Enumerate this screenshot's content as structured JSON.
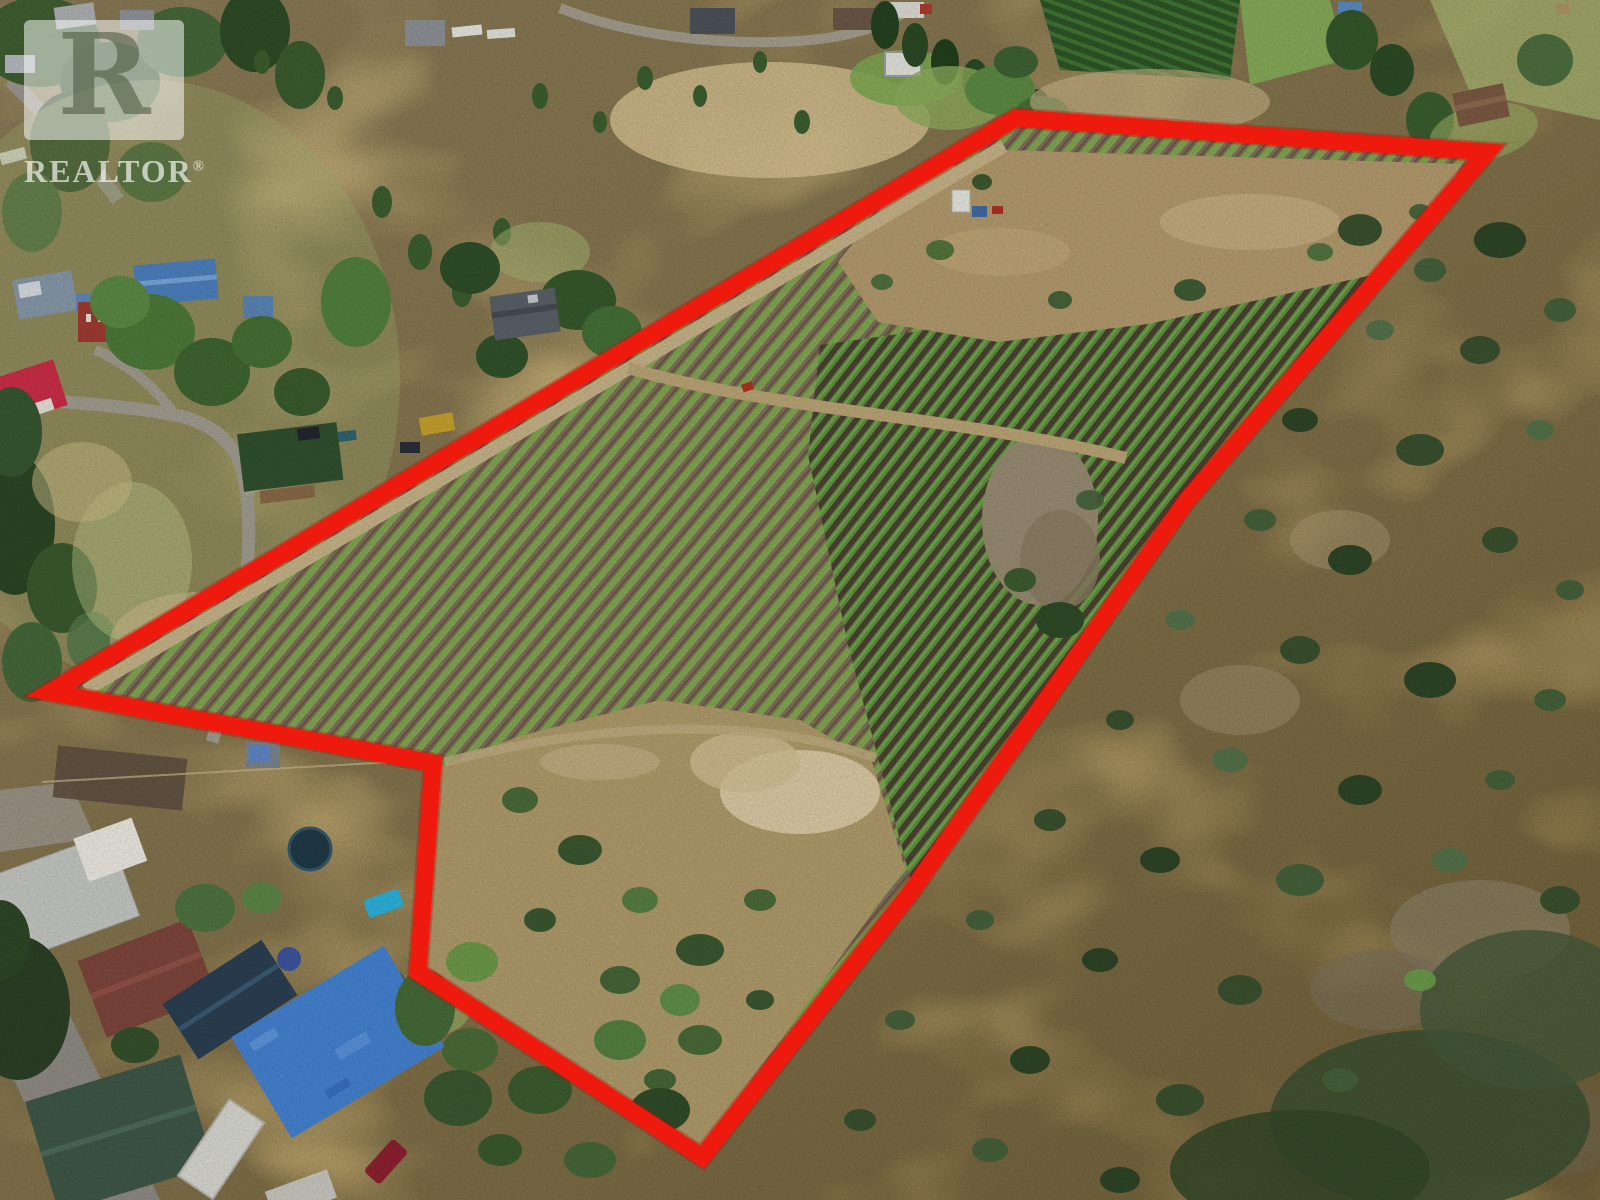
{
  "watermark": {
    "logo_letter": "R",
    "brand": "REALTOR",
    "registered_mark": "®"
  },
  "boundary": {
    "color": "#ef1a0e",
    "shadow_color": "#b80e06",
    "stroke_width": 17,
    "points": "1016,118 1487,152 1187,500 910,893 702,1157 418,972 433,763 50,692"
  },
  "photo": {
    "description": "Aerial drone photograph of rural acreage: young vineyard rows on brown soil outlined by a red property boundary, dry grass scrubland to the right, residential yards lower-left",
    "palette": {
      "dry_grass": "#c4ac72",
      "vine_row_green": "#7fa94e",
      "dense_vine_green": "#5f9140",
      "soil_brown": "#7e6d55",
      "scrub_tree_green": "#3b5730",
      "road_gray": "#a29d90"
    }
  }
}
